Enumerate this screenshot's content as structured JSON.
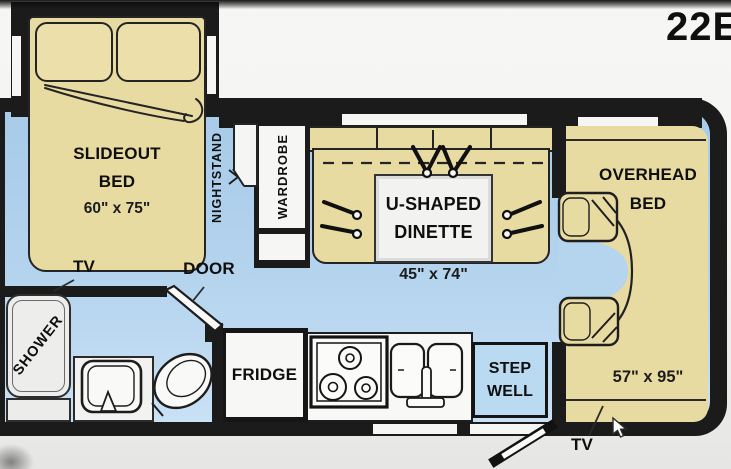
{
  "model": "22E",
  "colors": {
    "floor_blue": "#aecfeb",
    "furniture_tan": "#e8dba2",
    "wall_black": "#1b1b1b",
    "fixture_white": "#f6f6f5",
    "background": "#f2f2f0"
  },
  "floorplan": {
    "slideout_bed": {
      "line1": "SLIDEOUT",
      "line2": "BED",
      "dims": "60\" x 75\""
    },
    "nightstand": {
      "label": "NIGHTSTAND"
    },
    "wardrobe": {
      "label": "WARDROBE"
    },
    "dinette": {
      "line1": "U-SHAPED",
      "line2": "DINETTE",
      "dims": "45\" x 74\""
    },
    "overhead_bed": {
      "line1": "OVERHEAD",
      "line2": "BED",
      "dims": "57\" x 95\""
    },
    "shower": {
      "label": "SHOWER"
    },
    "fridge": {
      "label": "FRIDGE"
    },
    "step_well": {
      "line1": "STEP",
      "line2": "WELL"
    },
    "labels": {
      "tv_rear": "TV",
      "door": "DOOR",
      "tv_front": "TV"
    }
  }
}
